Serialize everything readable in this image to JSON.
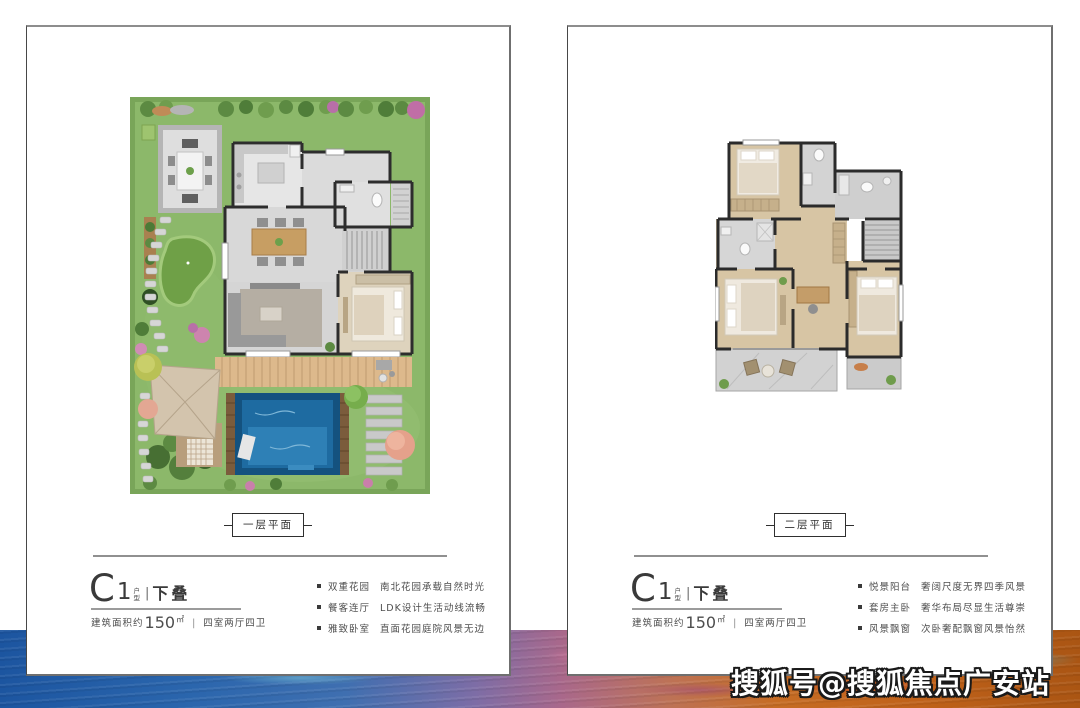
{
  "page": {
    "watermark": "搜狐号@搜狐焦点广安站"
  },
  "palette": {
    "card_border": "#6f6f6f",
    "text_primary": "#3a3a3a",
    "text_secondary": "#4d4d4d",
    "lawn_green": "#8cb86a",
    "pool_blue": "#1e6ba1",
    "deck_wood": "#ddb98c",
    "band_blue": "#2b66ad",
    "band_purple": "#a9688b",
    "band_orange": "#c0621a"
  },
  "cards": [
    {
      "plan_label": "一层平面",
      "title": {
        "letter": "C",
        "number": "1",
        "small_top": "户",
        "small_bottom": "型",
        "divider": "|",
        "suffix": "下叠"
      },
      "area": {
        "prefix": "建筑面积约",
        "value": "150",
        "unit": "㎡",
        "divider": "|",
        "rooms": "四室两厅四卫"
      },
      "features": [
        {
          "title": "双重花园",
          "desc": "南北花园承载自然时光"
        },
        {
          "title": "餐客连厅",
          "desc": "LDK设计生活动线流畅"
        },
        {
          "title": "雅致卧室",
          "desc": "直面花园庭院风景无边"
        }
      ]
    },
    {
      "plan_label": "二层平面",
      "title": {
        "letter": "C",
        "number": "1",
        "small_top": "户",
        "small_bottom": "型",
        "divider": "|",
        "suffix": "下叠"
      },
      "area": {
        "prefix": "建筑面积约",
        "value": "150",
        "unit": "㎡",
        "divider": "|",
        "rooms": "四室两厅四卫"
      },
      "features": [
        {
          "title": "悦景阳台",
          "desc": "奢阔尺度无界四季风景"
        },
        {
          "title": "套房主卧",
          "desc": "奢华布局尽显生活尊崇"
        },
        {
          "title": "风景飘窗",
          "desc": "次卧奢配飘窗风景怡然"
        }
      ]
    }
  ]
}
